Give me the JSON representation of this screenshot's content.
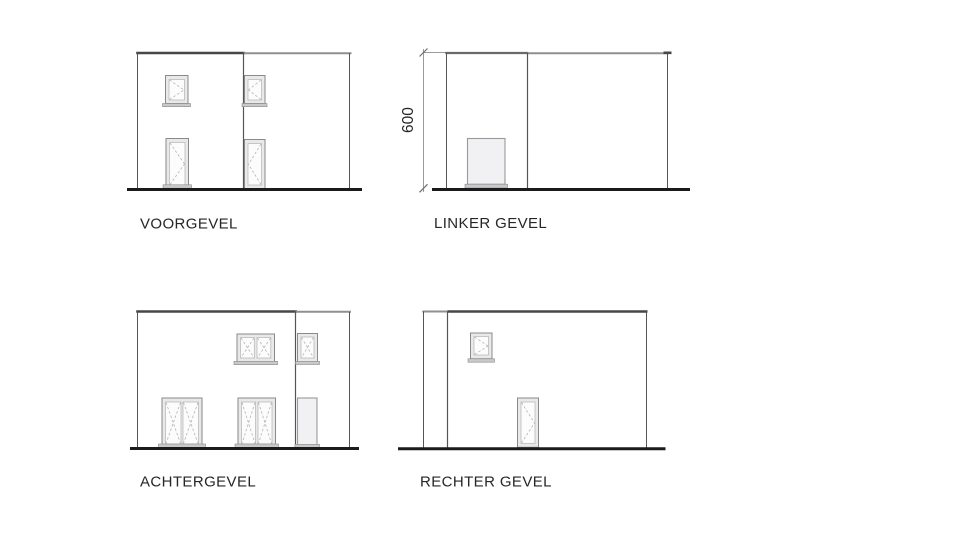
{
  "sheet": {
    "kind": "facade-elevations"
  },
  "elevations": [
    {
      "id": "voorgevel",
      "label": "VOORGEVEL"
    },
    {
      "id": "linker-gevel",
      "label": "LINKER GEVEL",
      "height_dimension": "600"
    },
    {
      "id": "achtergevel",
      "label": "ACHTERGEVEL"
    },
    {
      "id": "rechter-gevel",
      "label": "RECHTER GEVEL"
    }
  ],
  "colors": {
    "background": "#ffffff",
    "wall_line": "#555555",
    "top_edge_dark": "#474747",
    "top_edge_light": "#8f8f8f",
    "ground_line": "#1b1b1b",
    "frame_stroke": "#8a8a8a",
    "frame_fill": "#e9e9e9",
    "glass_fill": "#fcfcfc",
    "glass_stroke": "#b3b3b3",
    "swing_dash": "#b5b5b5",
    "sill_fill": "#c9c9c9",
    "opening_fill": "#f1f1f3",
    "dimension_line": "#9a9a9a",
    "label_text": "#262626"
  }
}
